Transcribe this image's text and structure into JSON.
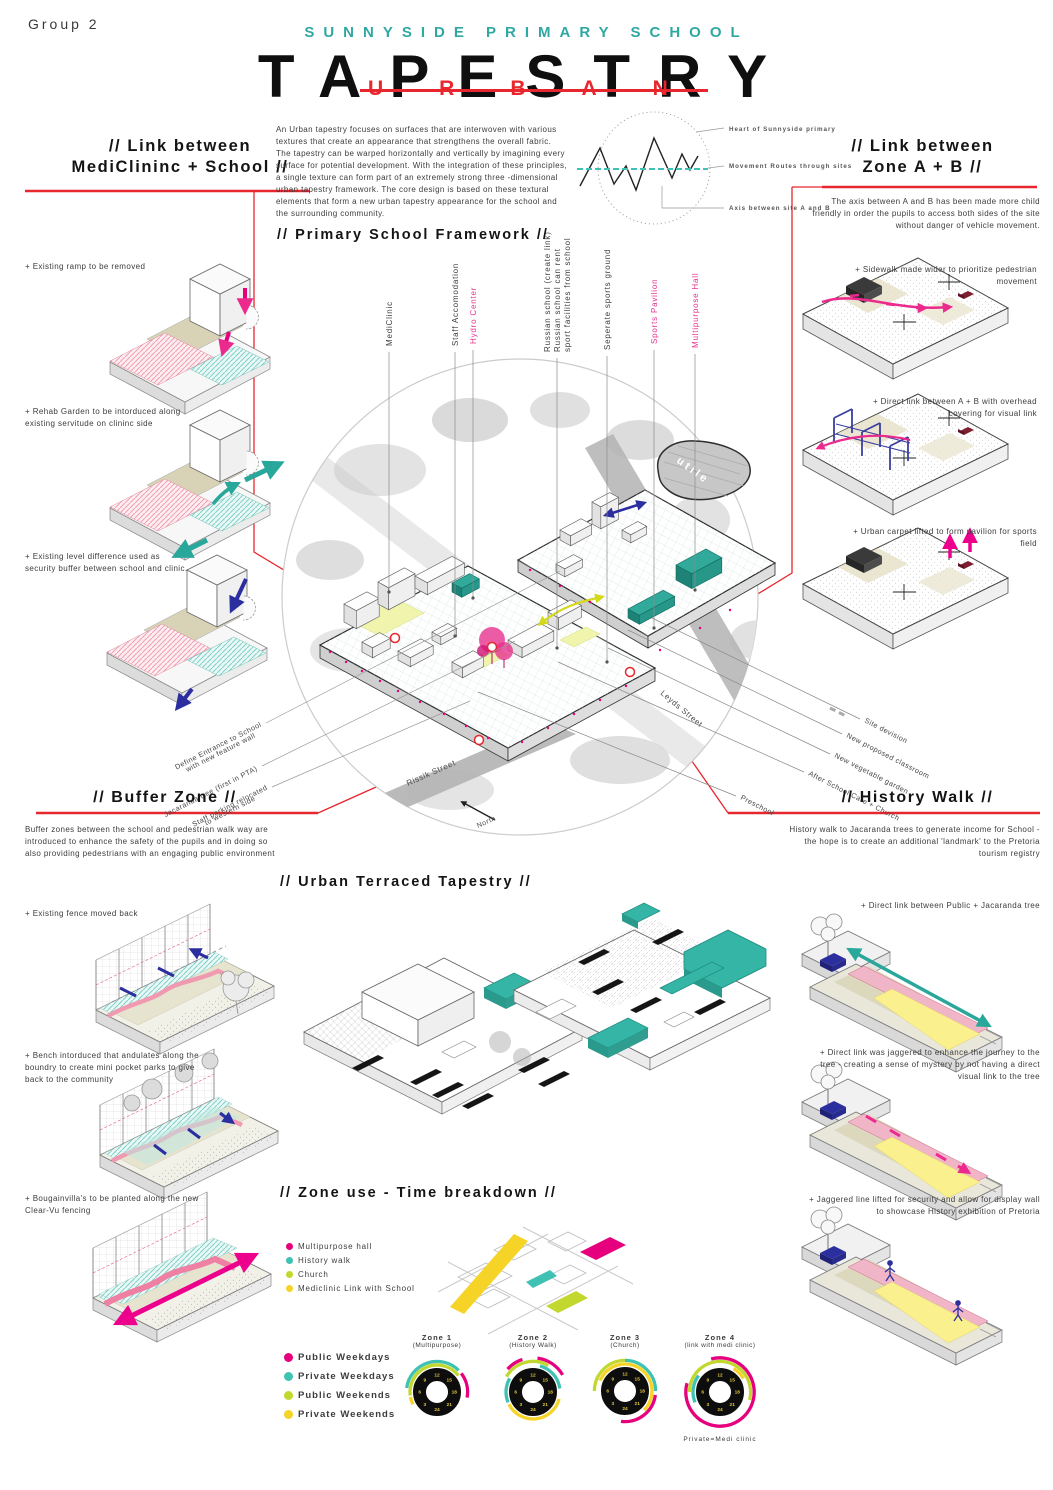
{
  "page": {
    "group_label": "Group 2"
  },
  "header": {
    "school": "SUNNYSIDE PRIMARY SCHOOL",
    "title": "TAPESTRY",
    "overlay": "URBAN"
  },
  "intro": {
    "body": "An Urban tapestry focuses on surfaces that are interwoven with various textures that create an appearance that strengthens the overall fabric. The tapestry can be warped horizontally and vertically by imagining every surface for potential development. With the integration of these principles, a single texture can form part of an extremely strong three -dimensional urban tapestry framework. The core design is based on these textural elements that form a new urban tapestry appearance for the school and the surrounding community."
  },
  "concept": {
    "labels": {
      "heart": "Heart of Sunnyside primary",
      "routes": "Movement Routes through sites",
      "axis": "Axis between site A and B"
    }
  },
  "left_top": {
    "heading1": "// Link between",
    "heading2": "MediClininc + School //",
    "items": [
      "+ Existing ramp to be removed",
      "+ Rehab Garden to be intorduced along existing servitude on clininc side",
      "+ Existing level difference used as security buffer between school and clinic."
    ]
  },
  "right_top": {
    "heading1": "// Link between",
    "heading2": "Zone A + B //",
    "body": "The axis between A and B has been made more child friendly in order the pupils to access both sides of the site without danger of vehicle movement.",
    "items": [
      "+ Sidewalk made wider to prioritize pedestrian movement",
      "+ Direct link between A + B with overhead covering for visual link",
      "+ Urban carpet lifted to form pavilion for sports field"
    ]
  },
  "framework": {
    "heading": "// Primary School Framework //",
    "top_labels": [
      "MediClinic",
      "Staff Accomodation",
      "Hydro Center",
      "Russian school (create link)",
      "Russian school can rent",
      "sport facilities from school",
      "Seperate sports ground",
      "Sports Pavilion",
      "Multipurpose Hall"
    ],
    "bl_labels": [
      "Define Entrance to School",
      "with new feature wall",
      "Jacaranda tree (first in PTA)",
      "Staff parking relocated",
      "to western side"
    ],
    "br_labels": [
      "Site devision",
      "New proposed classroom",
      "New vegetable garden",
      "After School Care + Church",
      "Preschool"
    ],
    "streets": [
      "Leyds Street",
      "Rissik Street"
    ],
    "north": "North",
    "blob": "utile"
  },
  "buffer": {
    "heading": "// Buffer Zone //",
    "body": "Buffer zones between the school and pedestrian walk way are introduced to enhance the safety of the pupils and in doing so also providing pedestrians with an engaging public environment"
  },
  "left_bottom": {
    "items": [
      "+ Existing fence moved back",
      "+ Bench intorduced that andulates along the boundry to create mini pocket parks to give back to the community",
      "+ Bougainvilla's to be planted along the new Clear-Vu fencing"
    ]
  },
  "history": {
    "heading": "// History Walk //",
    "body": "History walk to Jacaranda trees to generate income for School - the hope is to create an additional 'landmark' to the Pretoria tourism registry"
  },
  "right_bottom": {
    "items": [
      "+ Direct link between Public + Jacaranda tree",
      "+ Direct link was jaggered to enhance the journey to the tree - creating a sense of mystery by not having a direct visual link to the tree",
      "+ Jaggered line lifted for security and allow for display wall to showcase History exhibition of Pretoria"
    ]
  },
  "terraced": {
    "heading": "// Urban Terraced Tapestry //"
  },
  "zoneuse": {
    "heading": "// Zone use - Time breakdown //",
    "legend_zones": [
      {
        "label": "Multipurpose hall",
        "color": "#e6007e"
      },
      {
        "label": "History walk",
        "color": "#3fc2b4"
      },
      {
        "label": "Church",
        "color": "#c3d82e"
      },
      {
        "label": "Mediclinic Link with School",
        "color": "#f5d327"
      }
    ],
    "legend_time": [
      {
        "label": "Public Weekdays",
        "color": "#e6007e"
      },
      {
        "label": "Private Weekdays",
        "color": "#3fc2b4"
      },
      {
        "label": "Public Weekends",
        "color": "#c3d82e"
      },
      {
        "label": "Private Weekends",
        "color": "#f5d327"
      }
    ],
    "footnote": "Private=Medi clinic"
  },
  "chart_data": {
    "type": "donut-clock-arcs",
    "title": "// Zone use - Time breakdown //",
    "clock_hour_ticks": [
      12,
      15,
      18,
      21,
      24,
      3,
      6,
      9
    ],
    "series_colors": {
      "Public Weekdays": "#e6007e",
      "Private Weekdays": "#3fc2b4",
      "Public Weekends": "#c3d82e",
      "Private Weekends": "#f5d327"
    },
    "zones": [
      {
        "name": "Zone 1",
        "subtitle": "(Multipurpose)",
        "arcs": [
          {
            "series": "Public Weekends",
            "from_h": 5.5,
            "to_h": 15.5,
            "tier": 1
          },
          {
            "series": "Private Weekdays",
            "from_h": 6.5,
            "to_h": 15,
            "tier": 2
          },
          {
            "series": "Private Weekends",
            "from_h": 4.2,
            "to_h": 5.3,
            "tier": 1
          },
          {
            "series": "Public Weekdays",
            "from_h": 15.5,
            "to_h": 18.7,
            "tier": 2
          }
        ]
      },
      {
        "name": "Zone 2",
        "subtitle": "(History Walk)",
        "arcs": [
          {
            "series": "Public Weekends",
            "from_h": 8,
            "to_h": 14,
            "tier": 2
          },
          {
            "series": "Private Weekdays",
            "from_h": 4.5,
            "to_h": 8,
            "tier": 1
          },
          {
            "series": "Private Weekdays",
            "from_h": 13,
            "to_h": 17.5,
            "tier": 1
          },
          {
            "series": "Public Weekdays",
            "from_h": 8.8,
            "to_h": 10.8,
            "tier": 3
          },
          {
            "series": "Public Weekdays",
            "from_h": 12.5,
            "to_h": 16,
            "tier": 3
          },
          {
            "series": "Private Weekends",
            "from_h": 19,
            "to_h": 28.2,
            "tier": 1
          }
        ]
      },
      {
        "name": "Zone 3",
        "subtitle": "(Church)",
        "arcs": [
          {
            "series": "Public Weekends",
            "from_h": 6,
            "to_h": 12,
            "tier": 2
          },
          {
            "series": "Private Weekdays",
            "from_h": 12,
            "to_h": 18,
            "tier": 2
          },
          {
            "series": "Private Weekends",
            "from_h": 7.5,
            "to_h": 21,
            "tier": 1
          },
          {
            "series": "Public Weekdays",
            "from_h": 18.5,
            "to_h": 24.5,
            "tier": 2
          }
        ]
      },
      {
        "name": "Zone 4",
        "subtitle": "(link with medi clinic)",
        "arcs": [
          {
            "series": "Private Weekdays",
            "from_h": 4.5,
            "to_h": 8.5,
            "tier": 1
          },
          {
            "series": "Public Weekends",
            "from_h": 6,
            "to_h": 19,
            "tier": 2
          },
          {
            "series": "Private Weekends",
            "from_h": 14,
            "to_h": 16,
            "tier": 1
          },
          {
            "series": "Public Weekdays",
            "from_h": 11,
            "to_h": 31,
            "tier": 3
          }
        ]
      }
    ]
  }
}
